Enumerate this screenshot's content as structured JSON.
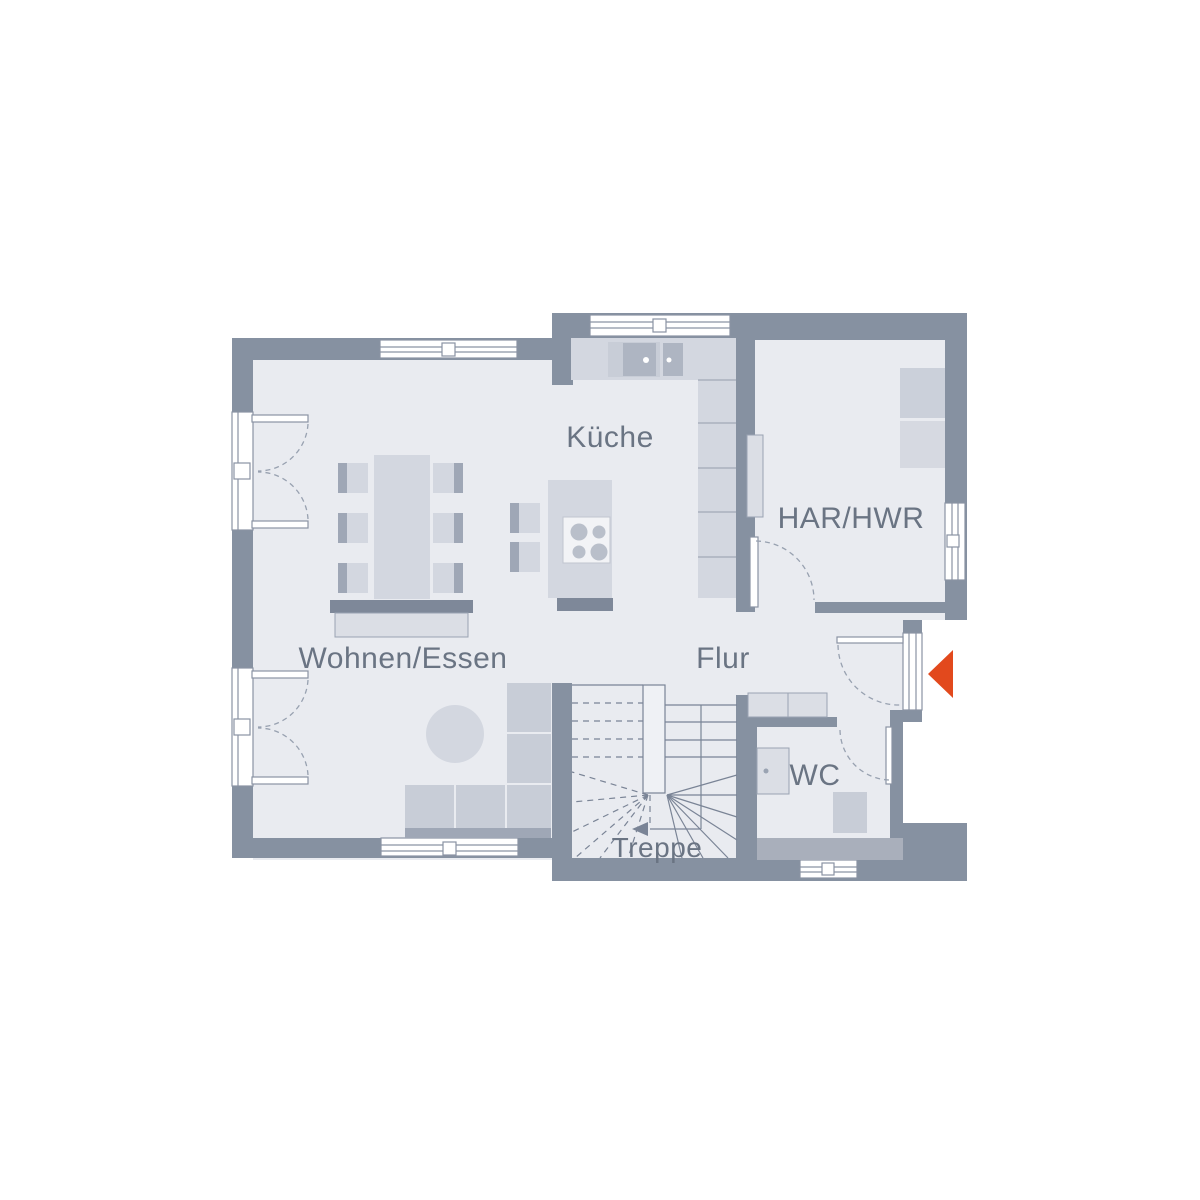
{
  "plan": {
    "title": "Erdgeschoss Grundriss",
    "rooms": [
      {
        "id": "kueche",
        "label": "Küche"
      },
      {
        "id": "har_hwr",
        "label": "HAR/HWR"
      },
      {
        "id": "wohnen_essen",
        "label": "Wohnen/Essen"
      },
      {
        "id": "flur",
        "label": "Flur"
      },
      {
        "id": "wc",
        "label": "WC"
      },
      {
        "id": "treppe",
        "label": "Treppe"
      }
    ],
    "entrance_marker": {
      "icon": "arrow-left-icon",
      "color": "#E2491D"
    },
    "colors": {
      "wall": "#8691A1",
      "floor": "#E9EBF0",
      "furniture": "#D3D7E0",
      "label_text": "#6A7483",
      "entrance_arrow": "#E2491D"
    }
  }
}
